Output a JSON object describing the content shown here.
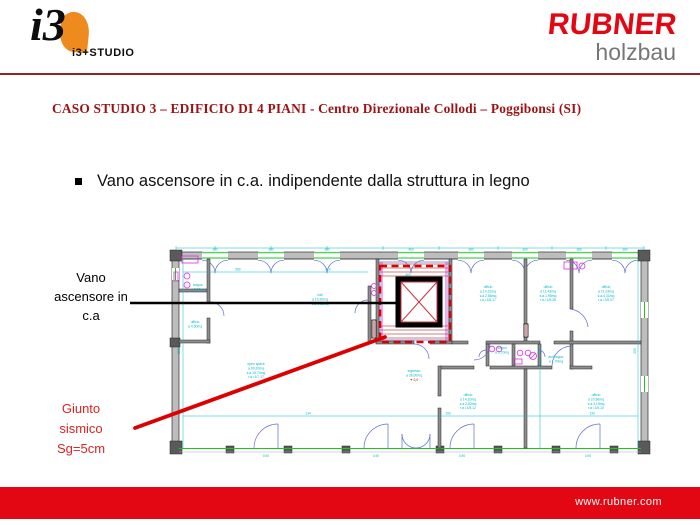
{
  "slide": {
    "header": {
      "logo_i3": {
        "mark": "i3",
        "caption": "i3+STUDIO"
      },
      "logo_rubner": {
        "brand": "RUBNER",
        "division": "holzbau"
      }
    },
    "title": "CASO STUDIO 3 – EDIFICIO DI 4 PIANI -  Centro Direzionale Collodi – Poggibonsi (SI)",
    "bullet": "Vano ascensore in c.a. indipendente dalla struttura in legno",
    "callouts": {
      "vano": {
        "lines": [
          "Vano",
          "ascensore in",
          "c.a"
        ]
      },
      "giunto": {
        "lines": [
          "Giunto",
          "sismico",
          "Sg=5cm"
        ]
      }
    },
    "footer": {
      "url": "www.rubner.com"
    }
  },
  "colors": {
    "rubner_red": "#e30613",
    "title_red": "#9d1215",
    "separator_maroon": "#8c2433",
    "holzbau_gray": "#767676",
    "logo_orange": "#ee8a1e",
    "cad_cyan": "#00b9c9",
    "cad_magenta": "#e128e1",
    "cad_green": "#1ec31e",
    "cad_blue": "#5b6bd5",
    "cad_red": "#dd0000"
  },
  "plan": {
    "rooms": [
      {
        "x": 27,
        "y": 77,
        "lines": [
          "ufficio",
          "a 4,50mq"
        ]
      },
      {
        "x": 30,
        "y": 40,
        "lines": [
          "bagno",
          "a 3,60mq"
        ]
      },
      {
        "x": 88,
        "y": 119,
        "lines": [
          "open space",
          "a 99,20mq",
          "s.a.15,74mq",
          "r.a.i 1/7,17"
        ]
      },
      {
        "x": 152,
        "y": 50,
        "lines": [
          "hall",
          "a 19,30mq",
          "s.a.3,86mq"
        ]
      },
      {
        "x": 320,
        "y": 42,
        "lines": [
          "ufficio",
          "a 14,31mq",
          "s.a.2,86mq",
          "r.a.i 1/5,17"
        ]
      },
      {
        "x": 380,
        "y": 42,
        "lines": [
          "ufficio",
          "a 11,43mq",
          "s.a.1,96mq",
          "r.a.i 1/5,28"
        ]
      },
      {
        "x": 438,
        "y": 42,
        "lines": [
          "ufficio",
          "a 21,03mq",
          "s.a.4,31mq",
          "r.a.i 1/5,07"
        ]
      },
      {
        "x": 300,
        "y": 150,
        "lines": [
          "ufficio",
          "a 14,10mq",
          "s.a.2,82mq",
          "r.a.i 1/5,12"
        ]
      },
      {
        "x": 428,
        "y": 150,
        "lines": [
          "ufficio",
          "a 20,96mq",
          "s.a.4,19mq",
          "r.a.i 1/5,10"
        ]
      },
      {
        "x": 334,
        "y": 103,
        "lines": [
          "bagno",
          "a 3,70mq"
        ]
      },
      {
        "x": 388,
        "y": 112,
        "lines": [
          "antibagno",
          "a 1,70mq"
        ]
      },
      {
        "x": 246,
        "y": 126,
        "lines": [
          "ingresso",
          "a 36,00mq"
        ]
      },
      {
        "x": 246,
        "y": 135,
        "cls": "red",
        "lines": [
          "✦ 0,0"
        ]
      }
    ],
    "dims": [
      {
        "x": 47,
        "y": 4.4,
        "t": "380"
      },
      {
        "x": 103,
        "y": 4.4,
        "t": "380"
      },
      {
        "x": 159,
        "y": 4.4,
        "t": "380"
      },
      {
        "x": 243,
        "y": 4.4,
        "t": "460"
      },
      {
        "x": 303,
        "y": 4.4,
        "t": "380"
      },
      {
        "x": 357,
        "y": 4.4,
        "t": "380"
      },
      {
        "x": 411,
        "y": 4.4,
        "t": "380"
      },
      {
        "x": 457,
        "y": 4.4,
        "t": "380"
      },
      {
        "x": 70,
        "y": 24.6,
        "t": "580"
      },
      {
        "x": 160,
        "y": 24.6,
        "t": "410"
      },
      {
        "x": 240,
        "y": 30,
        "t": "460"
      },
      {
        "x": 140,
        "y": 168.6,
        "t": "134"
      },
      {
        "x": 280,
        "y": 168.6,
        "t": "150"
      },
      {
        "x": 424,
        "y": 168.6,
        "t": "130"
      },
      {
        "x": 98,
        "y": 211,
        "t": "0,90"
      },
      {
        "x": 208,
        "y": 211,
        "t": "0,90"
      },
      {
        "x": 294,
        "y": 211,
        "t": "0,90"
      },
      {
        "x": 420,
        "y": 211,
        "t": "0,90"
      },
      {
        "x": 12,
        "y": 105,
        "t": "250",
        "rot": true
      },
      {
        "x": 468,
        "y": 105,
        "t": "250",
        "rot": true
      }
    ]
  }
}
